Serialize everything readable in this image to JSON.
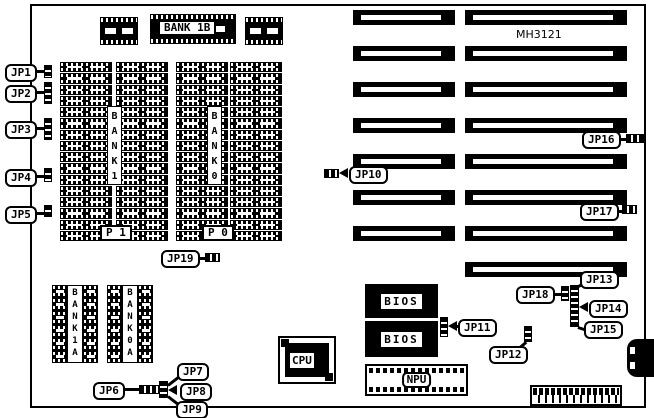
{
  "board": {
    "model": "MH3121"
  },
  "jumpers": {
    "jp1": "JP1",
    "jp2": "JP2",
    "jp3": "JP3",
    "jp4": "JP4",
    "jp5": "JP5",
    "jp6": "JP6",
    "jp7": "JP7",
    "jp8": "JP8",
    "jp9": "JP9",
    "jp10": "JP10",
    "jp11": "JP11",
    "jp12": "JP12",
    "jp13": "JP13",
    "jp14": "JP14",
    "jp15": "JP15",
    "jp16": "JP16",
    "jp17": "JP17",
    "jp18": "JP18",
    "jp19": "JP19"
  },
  "memory": {
    "bank1b": "BANK 1B",
    "bank1_vertical": "B\nA\nN\nK\n1",
    "bank0_vertical": "B\nA\nN\nK\n0",
    "bank1a_vertical": "B\nA\nN\nK\n1\nA",
    "bank0a_vertical": "B\nA\nN\nK\n0\nA",
    "p1": "P 1",
    "p0": "P 0"
  },
  "chips": {
    "cpu": "CPU",
    "npu": "NPU",
    "bios_top": "BIOS",
    "bios_bottom": "BIOS"
  },
  "colors": {
    "line": "#000000",
    "background": "#ffffff"
  }
}
